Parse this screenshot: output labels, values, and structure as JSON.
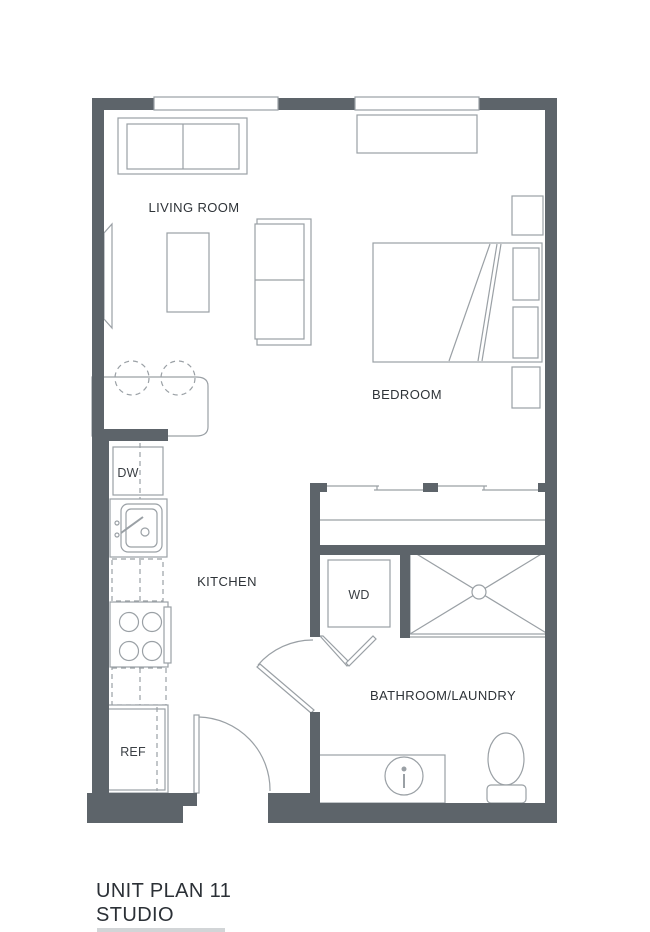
{
  "plan": {
    "unit_title": "UNIT PLAN 11",
    "unit_subtitle": "STUDIO",
    "rooms": {
      "living_room": "LIVING ROOM",
      "bedroom": "BEDROOM",
      "kitchen": "KITCHEN",
      "bathroom_laundry": "BATHROOM/LAUNDRY"
    },
    "appliances": {
      "dishwasher": "DW",
      "washer_dryer": "WD",
      "refrigerator": "REF"
    },
    "features": {
      "windows": 2,
      "bar_stools": 2,
      "doors": [
        "entry-swing-door",
        "bathroom-swing-door",
        "closet-bifold-door",
        "bedroom-sliding-doors"
      ]
    },
    "colors": {
      "wall": "#5d646a",
      "furniture_line": "#9aa0a5",
      "label_text": "#2e3338",
      "title_text": "#2b3036",
      "background": "#ffffff"
    }
  }
}
